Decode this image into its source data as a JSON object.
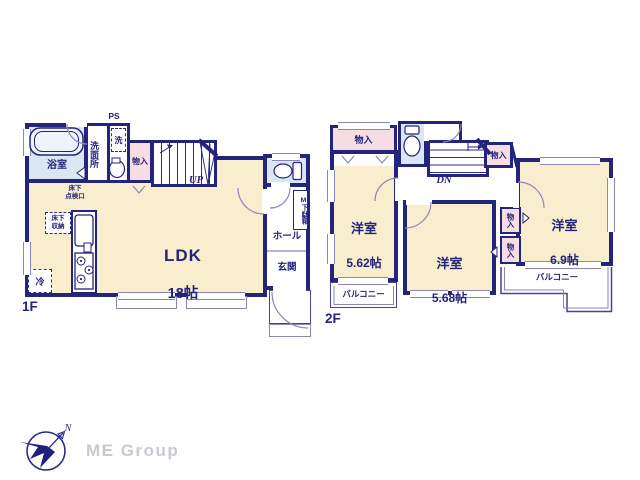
{
  "colors": {
    "wall_navy": "#24247c",
    "room_cream": "#f8eecd",
    "wet_area_blue": "#d9e7f3",
    "closet_pink": "#f6dde4",
    "thin_line_lavender": "#8b87b8",
    "brand_gray": "#c9c9d1"
  },
  "floor1": {
    "label": "1F",
    "ldk": {
      "name": "LDK",
      "size": "18帖"
    },
    "bath": "浴室",
    "washroom": "洗面所",
    "washer": "洗",
    "ps": "PS",
    "closet": "物入",
    "up": "UP",
    "hall": "ホール",
    "entrance": "玄関",
    "shoe_cabinet": "M下駄箱",
    "underfloor_hatch": "床下\n点検口",
    "underfloor_storage": "床下\n収納",
    "fridge": "冷"
  },
  "floor2": {
    "label": "2F",
    "closet_top": "物入",
    "closet_mid": "物入",
    "dn": "DN",
    "room_a": {
      "name": "洋室",
      "size": "5.62帖"
    },
    "room_b": {
      "name": "洋室",
      "size": "5.68帖"
    },
    "room_c": {
      "name": "洋室",
      "size": "6.9帖"
    },
    "closet_a": "物入",
    "closet_b": "物入",
    "balcony_left": "バルコニー",
    "balcony_right": "バルコニー"
  },
  "footer": {
    "brand": "ME Group",
    "north": "N"
  }
}
